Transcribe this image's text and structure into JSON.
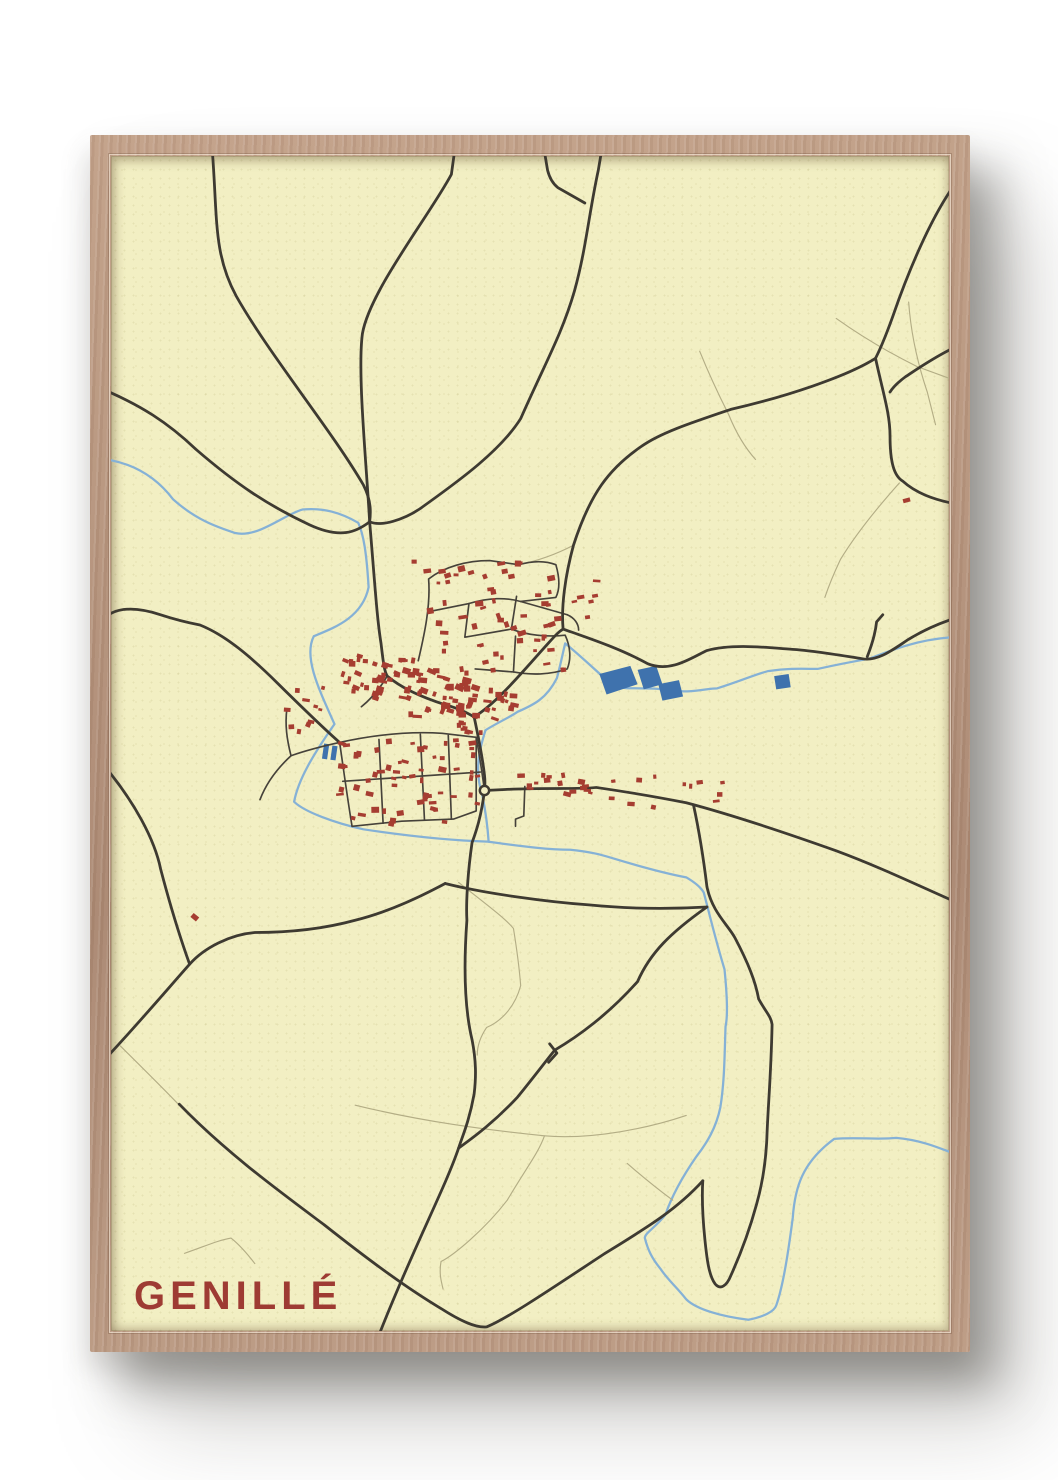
{
  "poster": {
    "title": "GENILLÉ",
    "title_color": "#9e3b33",
    "paper_color": "#f2efc3",
    "wall_color": "#ffffff"
  },
  "map": {
    "viewbox": "0 0 810 1150",
    "colors": {
      "road_major": "#3e3a31",
      "road_street": "#46423a",
      "road_faint": "#b3ad85",
      "river": "#85b1d6",
      "water_fill": "#3f72ad",
      "building": "#a63d31"
    },
    "roads_major": [
      "M98,-4 C103,62 99,96 121,137 C154,196 213,268 244,322 C252,338 251,350 250,358",
      "M332,-4 L329,18 C308,58 250,132 243,174 C238,212 247,302 250,358",
      "M474,-4 L471,14 C462,56 459,92 448,132 C436,174 420,202 396,257 C375,291 329,323 299,345 C283,356 261,363 250,358",
      "M419,-4 L422,14 C424,22 427,27 432,31 L458,46",
      "M-4,230 C28,244 54,260 82,287 C122,322 152,342 192,361 C222,375 237,368 250,358",
      "M250,358 C255,418 257,452 261,477 C263,494 264,504 267,509 C281,521 301,530 323,537 C337,541 344,545 351,549",
      "M351,549 C372,536 396,507 419,481 C428,471 432,466 437,463",
      "M437,463 C462,472 492,482 519,497 C541,506 561,491 576,484 C601,477 633,481 661,483 C677,484 701,488 726,492 C741,495 756,483 771,473 C784,465 796,459 814,453",
      "M739,198 C746,231 753,252 753,274 C753,300 757,313 765,318 C778,330 795,336 814,340",
      "M814,30 C792,62 771,112 756,156 C749,176 743,190 739,198",
      "M739,198 C711,216 651,236 599,248 C561,261 531,271 513,284 C481,306 463,331 447,381 C439,411 435,441 437,463",
      "M814,188 C794,198 780,208 768,216 C760,222 756,226 753,231",
      "M351,549 C355,568 359,588 361,606 C362,615 361,619 361,621",
      "M361,621 C358,646 353,661 349,672 C345,700 343,730 344,748 C341,790 341,831 349,865 C353,886 353,901 351,918 C346,946 339,961 336,971 C323,1010 291,1071 259,1154",
      "M361,621 L381,620 C421,618 451,620 469,618 C496,622 531,628 556,633 C601,645 651,662 701,680 C741,695 776,712 814,729",
      "M563,635 C569,663 573,690 576,715 C581,740 596,752 603,765 C616,790 623,808 626,825 C633,838 638,842 639,850 C638,900 635,930 634,960 C633,986 629,1008 624,1026 C617,1052 608,1076 599,1096 C595,1106 589,1110 584,1104 C578,1096 576,1080 574,1060 C572,1040 571,1020 572,1003",
      "M576,735 C541,760 521,780 509,808 C481,840 451,862 429,875 C421,885 406,905 393,921 C371,945 351,960 336,971",
      "M424,869 L431,878 L423,887",
      "M323,712 C290,730 260,742 236,748 C200,758 165,760 139,760 C115,762 90,775 76,791 C55,815 30,845 -4,882",
      "M76,791 C65,760 55,725 48,698 C42,668 22,632 -4,600",
      "M323,712 C362,722 422,730 462,733 C502,737 542,737 576,735",
      "M66,928 C111,975 161,1012 206,1046 C251,1082 286,1108 319,1128 C339,1141 353,1147 363,1146 C383,1138 431,1105 476,1075 C516,1050 546,1032 572,1003",
      "M-4,450 C10,440 30,443 48,449 C66,455 76,457 86,459 C111,469 136,491 161,516 C181,536 201,556 221,574",
      "M731,490 C736,477 739,466 740,456 L746,449"
    ],
    "roads_street": [
      "M221,574 C252,567 287,563 320,565 L353,569",
      "M353,569 C357,591 359,606 361,621",
      "M233,656 L281,651 L331,649 L353,641 L353,569",
      "M221,574 C225,602 229,632 233,656",
      "M259,571 L263,653",
      "M299,566 L303,650",
      "M326,567 L329,649",
      "M224,612 L357,603",
      "M221,574 C203,578 188,582 174,587 C170,571 168,557 170,541",
      "M267,509 C260,521 252,531 242,539",
      "M297,494 C303,468 309,440 307,414 C322,402 344,396 366,396 L394,400",
      "M307,446 L346,438 C366,432 381,432 396,436 L441,449",
      "M346,438 L342,471 L387,463 L392,431",
      "M387,463 C402,469 421,471 439,469 C444,480 445,492 441,502 C425,508 405,508 389,505 L391,470",
      "M352,502 L389,505",
      "M394,400 C408,396 420,396 430,400 C434,414 434,424 430,432 L396,436",
      "M441,449 C448,452 452,458 452,464",
      "M400,617 L399,646 L391,649 L391,656",
      "M174,587 C160,600 150,614 144,630"
    ],
    "roads_faint": [
      "M569,191 C579,216 591,241 597,253 C605,273 615,288 623,297",
      "M771,143 C773,171 779,201 789,231 L797,263",
      "M701,159 C726,177 753,193 779,206 L814,219",
      "M9,871 C29,891 49,911 66,929",
      "M236,929 C301,945 361,953 419,959 C466,963 521,951 556,939",
      "M419,959 C413,976 401,991 383,1022 C361,1051 331,1076 319,1082 C317,1093 319,1101 321,1109",
      "M499,986 C516,1001 531,1013 543,1022",
      "M336,711 C361,731 381,746 389,756 C393,781 395,799 396,812 C391,831 379,846 363,853 C357,862 354,872 354,880",
      "M71,1074 C91,1067 104,1061 116,1059 C126,1067 133,1076 139,1084",
      "M762,320 C740,345 720,370 705,395 C698,410 694,420 690,432",
      "M447,381 C430,390 414,396 394,400"
    ],
    "rivers": [
      "M-4,297 C20,301 42,312 60,336 C82,356 102,363 120,369 C142,374 167,351 185,346 C205,344 222,349 239,359 C244,370 247,388 249,422 C243,452 215,462 196,470 C186,490 200,520 216,556 C196,585 181,610 177,632 C187,642 217,653 244,659 C290,666 330,670 364,671 C400,676 424,679 444,679 C464,681 474,684 484,687 C510,695 535,702 556,706 C566,712 571,717 573,721 C578,740 584,766 593,796 C596,826 596,843 594,852 C593,881 593,906 589,931 C585,951 576,966 566,979 C551,1001 541,1021 536,1036 C526,1049 516,1054 516,1059 C519,1071 523,1079 531,1089 C539,1101 546,1106 556,1119 C566,1129 591,1136 616,1139 C631,1136 641,1131 643,1125 C650,1105 655,1070 659,1039 C661,1010 668,985 699,962 C720,960 740,963 759,961 C781,963 796,969 814,976",
      "M362,562 C356,581 351,601 359,626 C362,641 364,656 365,671",
      "M362,562 C371,556 386,549 393,544 C409,537 421,531 431,511 C435,496 437,485 439,477 C456,491 471,506 486,519 C501,523 521,519 541,523 C561,526 576,521 586,521 C611,513 626,506 636,504 C656,501 671,502 683,502 C701,498 716,495 733,492 C756,483 781,473 814,471"
    ],
    "lakes": [
      "472,507 502,499 509,517 479,527",
      "509,503 527,499 533,517 515,522",
      "529,517 549,513 553,529 533,533",
      "641,509 655,507 657,520 643,522"
    ],
    "ponds": [
      {
        "x": 206,
        "y": 575,
        "w": 5,
        "h": 15,
        "a": 8
      },
      {
        "x": 214,
        "y": 577,
        "w": 5,
        "h": 14,
        "a": 8
      }
    ],
    "building_clusters": [
      {
        "x": 302,
        "y": 398,
        "w": 146,
        "h": 106,
        "n": 52,
        "a": -8,
        "s": 7,
        "seed": 11
      },
      {
        "x": 224,
        "y": 489,
        "w": 74,
        "h": 42,
        "n": 38,
        "a": 14,
        "s": 8,
        "seed": 22
      },
      {
        "x": 282,
        "y": 503,
        "w": 74,
        "h": 48,
        "n": 40,
        "a": 12,
        "s": 8,
        "seed": 33
      },
      {
        "x": 338,
        "y": 520,
        "w": 52,
        "h": 42,
        "n": 22,
        "a": 10,
        "s": 7,
        "seed": 44
      },
      {
        "x": 218,
        "y": 568,
        "w": 138,
        "h": 86,
        "n": 58,
        "a": 3,
        "s": 7,
        "seed": 55
      },
      {
        "x": 396,
        "y": 606,
        "w": 150,
        "h": 32,
        "n": 24,
        "a": 2,
        "s": 6,
        "seed": 66
      },
      {
        "x": 552,
        "y": 612,
        "w": 40,
        "h": 22,
        "n": 6,
        "a": 2,
        "s": 6,
        "seed": 77
      },
      {
        "x": 412,
        "y": 402,
        "w": 58,
        "h": 72,
        "n": 13,
        "a": -5,
        "s": 6,
        "seed": 88
      },
      {
        "x": 160,
        "y": 520,
        "w": 55,
        "h": 48,
        "n": 10,
        "a": 10,
        "s": 6,
        "seed": 99
      },
      {
        "x": 300,
        "y": 556,
        "w": 60,
        "h": 26,
        "n": 10,
        "a": 8,
        "s": 6,
        "seed": 17
      }
    ],
    "buildings_single": [
      {
        "x": 81,
        "y": 745,
        "w": 7,
        "h": 5,
        "a": 40
      },
      {
        "x": 769,
        "y": 337,
        "w": 7,
        "h": 4,
        "a": -15
      },
      {
        "x": 293,
        "y": 397,
        "w": 5,
        "h": 4,
        "a": 0
      },
      {
        "x": 342,
        "y": 560,
        "w": 5,
        "h": 4,
        "a": 10
      }
    ],
    "roundabout": {
      "cx": 361,
      "cy": 621,
      "r": 4.5
    }
  }
}
